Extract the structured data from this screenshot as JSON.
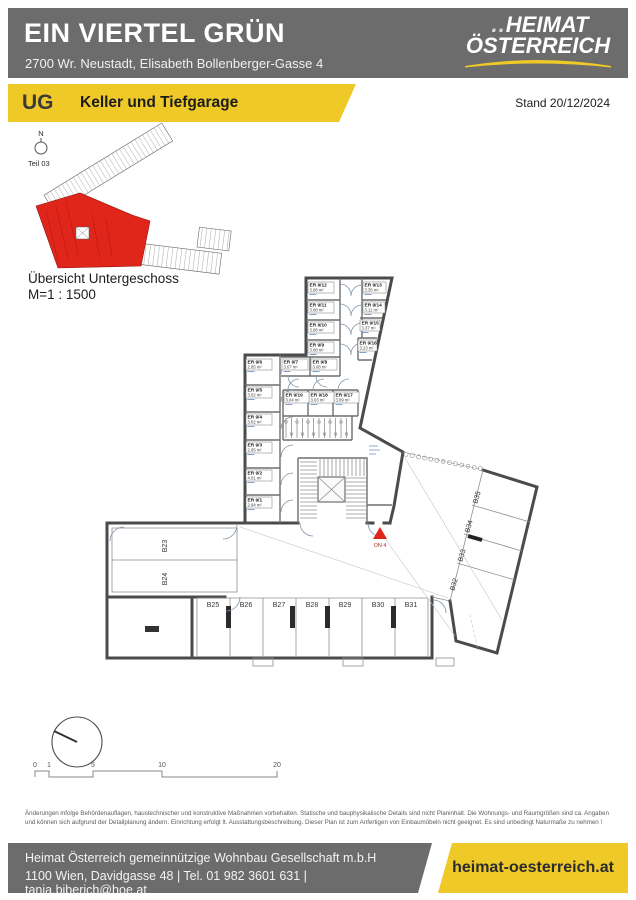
{
  "header": {
    "title": "EIN VIERTEL GRÜN",
    "address": "2700 Wr. Neustadt, Elisabeth Bollenberger-Gasse 4",
    "logo": {
      "dots": "..",
      "line1": "HEIMAT",
      "line2": "ÖSTERREICH"
    }
  },
  "subheader": {
    "level": "UG",
    "title": "Keller und Tiefgarage",
    "date_label": "Stand 20/12/2024"
  },
  "plan": {
    "north_label": "N",
    "part_label": "Teil 03",
    "overview_title": "Übersicht Untergeschoss",
    "overview_scale": "M=1 : 1500",
    "entrance_label": "ON 4",
    "storage_rooms": [
      {
        "id": "ER 9/1",
        "area": "2.94 m²"
      },
      {
        "id": "ER 9/2",
        "area": "4.01 m²"
      },
      {
        "id": "ER 9/3",
        "area": "2.95 m²"
      },
      {
        "id": "ER 9/4",
        "area": "3.02 m²"
      },
      {
        "id": "ER 9/5",
        "area": "3.02 m²"
      },
      {
        "id": "ER 9/6",
        "area": "2.85 m²"
      },
      {
        "id": "ER 9/7",
        "area": "3.07 m²"
      },
      {
        "id": "ER 9/8",
        "area": "3.08 m²"
      },
      {
        "id": "ER 9/9",
        "area": "3.08 m²"
      },
      {
        "id": "ER 9/10",
        "area": "3.08 m²"
      },
      {
        "id": "ER 9/11",
        "area": "3.08 m²"
      },
      {
        "id": "ER 9/12",
        "area": "3.08 m²"
      },
      {
        "id": "ER 9/13",
        "area": "3.35 m²"
      },
      {
        "id": "ER 9/14",
        "area": "3.11 m²"
      },
      {
        "id": "ER 9/15",
        "area": "3.37 m²"
      },
      {
        "id": "ER 9/16",
        "area": "3.23 m²"
      },
      {
        "id": "ER 9/17",
        "area": "3.09 m²"
      },
      {
        "id": "ER 9/18",
        "area": "3.03 m²"
      },
      {
        "id": "ER 9/19",
        "area": "3.04 m²"
      }
    ],
    "parking_spaces": [
      "B23",
      "B24",
      "B25",
      "B26",
      "B27",
      "B28",
      "B29",
      "B30",
      "B31",
      "B32",
      "B33",
      "B34",
      "B35"
    ]
  },
  "scalebar": {
    "labels": [
      "0",
      "1",
      "5",
      "10",
      "20"
    ]
  },
  "disclaimer": "Änderungen infolge Behördenauflagen, haustechnischer und konstruktive Maßnahmen vorbehalten. Statische und bauphysikalische Details sind nicht Planinhalt. Die Wohnungs- und Raumgrößen sind ca. Angaben und können sich aufgrund der Detailplanung ändern. Einrichtung erfolgt lt. Ausstattungsbeschreibung. Dieser Plan ist zum Anfertigen von Einbaumöbeln nicht geeignet. Es sind unbedingt Naturmaße zu nehmen !",
  "footer": {
    "company": "Heimat Österreich gemeinnützige Wohnbau Gesellschaft m.b.H",
    "contact": "1100 Wien, Davidgasse 48 | Tel. 01 982 3601 631 | tanja.biberich@hoe.at",
    "website": "heimat-oesterreich.at"
  },
  "colors": {
    "yellow": "#EFC928",
    "gray": "#6C6C6C",
    "red": "#E0251B"
  }
}
